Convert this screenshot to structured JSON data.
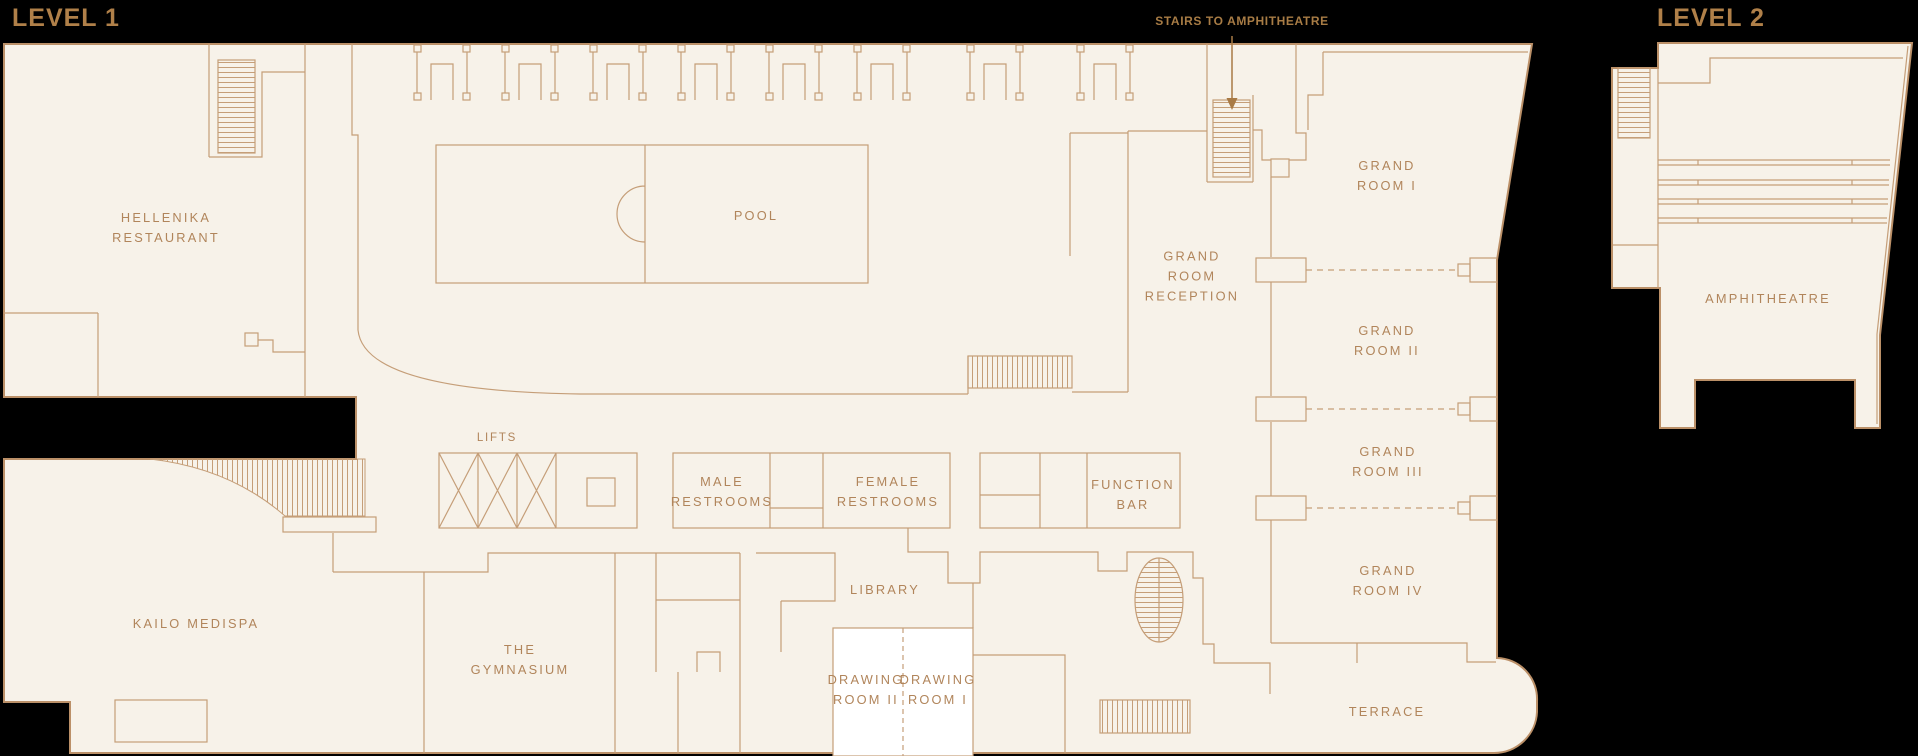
{
  "colors": {
    "background": "#000000",
    "floor_fill": "#f7f2e9",
    "wall_line": "#c59e78",
    "outer_wall": "#bb9068",
    "label_text": "#b1855b",
    "title_text": "#b08049",
    "highlight_room_fill": "#ffffff"
  },
  "titles": {
    "level1": "LEVEL 1",
    "level2": "LEVEL 2"
  },
  "annotations": {
    "stairs_note": "STAIRS TO AMPHITHEATRE"
  },
  "level1": {
    "rooms": {
      "hellenika": "HELLENIKA\nRESTAURANT",
      "pool": "POOL",
      "grand_room_1": "GRAND\nROOM I",
      "grand_room_reception": "GRAND\nROOM\nRECEPTION",
      "grand_room_2": "GRAND\nROOM II",
      "grand_room_3": "GRAND\nROOM III",
      "grand_room_4": "GRAND\nROOM IV",
      "terrace": "TERRACE",
      "function_bar": "FUNCTION\nBAR",
      "male_restrooms": "MALE\nRESTROOMS",
      "female_restrooms": "FEMALE\nRESTROOMS",
      "lifts": "LIFTS",
      "kailo_medispa": "KAILO MEDISPA",
      "the_gymnasium": "THE\nGYMNASIUM",
      "library": "LIBRARY",
      "drawing_room_2": "DRAWING\nROOM II",
      "drawing_room_1": "DRAWING\nROOM I"
    }
  },
  "level2": {
    "rooms": {
      "amphitheatre": "AMPHITHEATRE"
    }
  }
}
